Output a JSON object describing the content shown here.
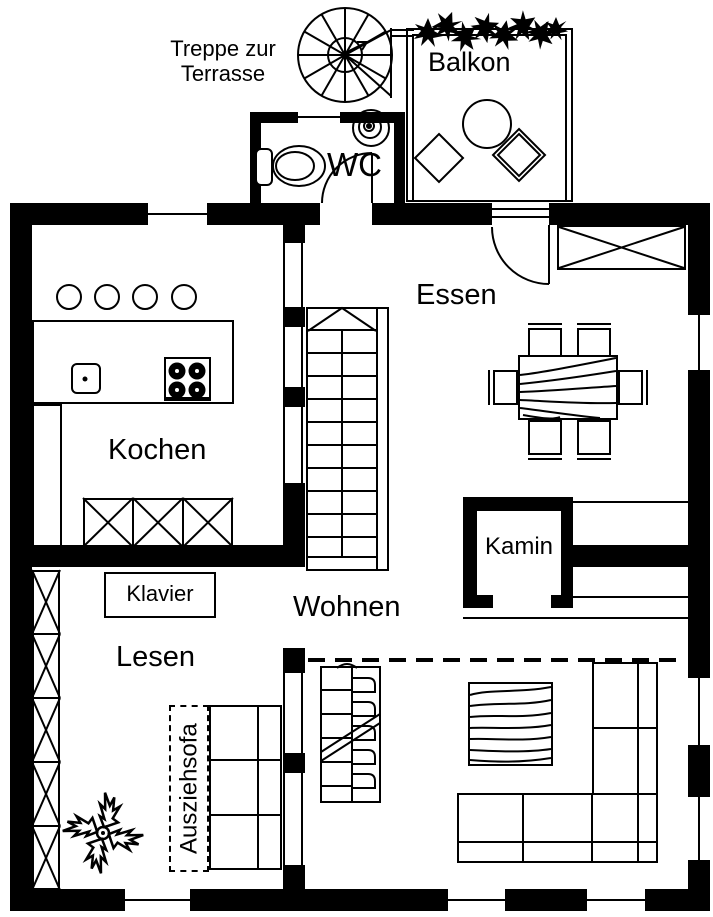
{
  "colors": {
    "ink": "#000000",
    "paper": "#ffffff"
  },
  "annotations": {
    "stair_note_line1": "Treppe zur",
    "stair_note_line2": "Terrasse"
  },
  "rooms": {
    "balkon": "Balkon",
    "wc": "WC",
    "essen": "Essen",
    "kochen": "Kochen",
    "wohnen": "Wohnen",
    "lesen": "Lesen"
  },
  "furniture": {
    "kamin": "Kamin",
    "klavier": "Klavier",
    "ausziehsofa": "Ausziehsofa"
  }
}
